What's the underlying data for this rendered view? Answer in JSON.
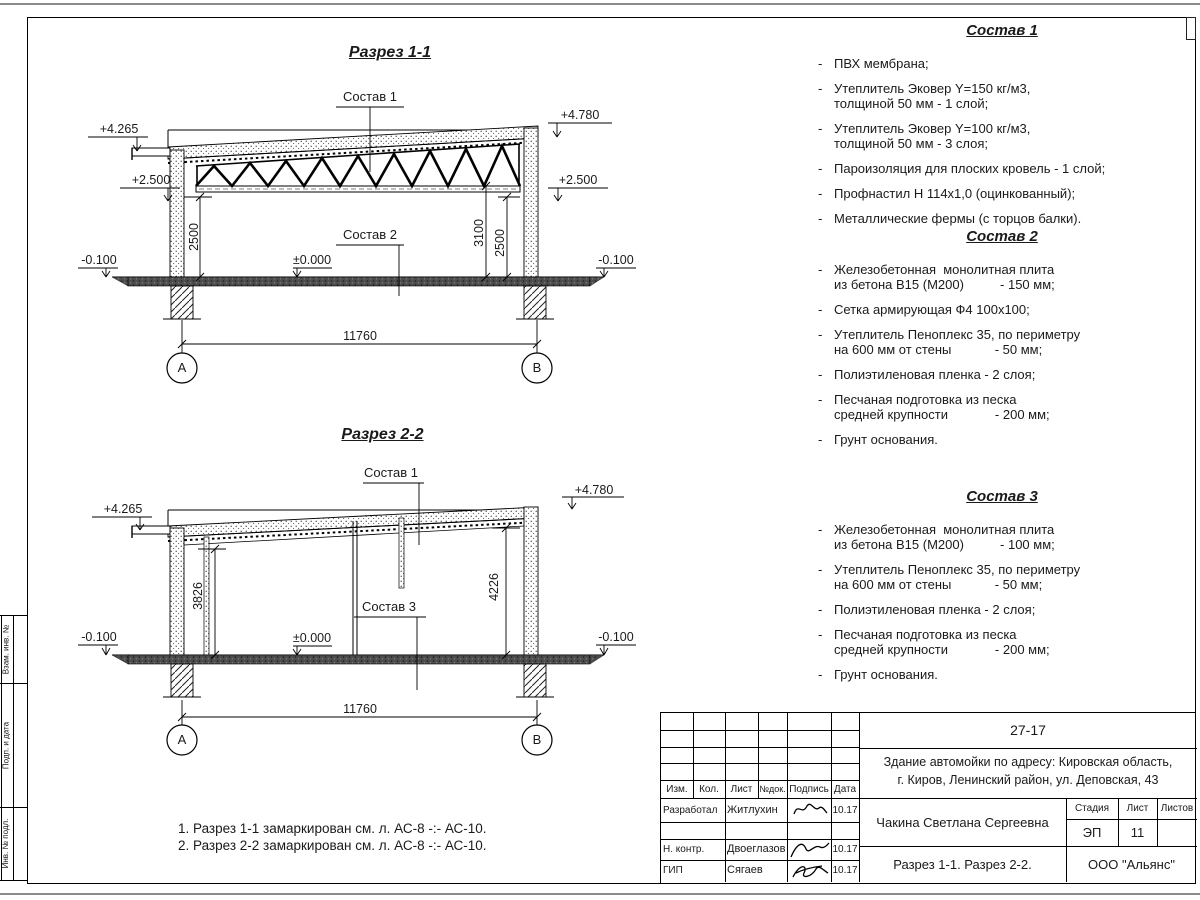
{
  "dash": "-",
  "section1": {
    "title": "Разрез 1-1",
    "callout_top": "Состав 1",
    "callout_mid": "Состав 2",
    "elev_top_left": "+4.265",
    "elev_top_right": "+4.780",
    "elev_mid_left": "+2.500",
    "elev_mid_right": "+2.500",
    "elev_zero": "±0.000",
    "elev_ground_left": "-0.100",
    "elev_ground_right": "-0.100",
    "dim_left": "2500",
    "dim_right_inner": "3100",
    "dim_right_outer": "2500",
    "dim_span": "11760",
    "axis_left": "А",
    "axis_right": "В"
  },
  "section2": {
    "title": "Разрез 2-2",
    "callout_top": "Состав 1",
    "callout_mid": "Состав 3",
    "elev_top_left": "+4.265",
    "elev_top_right": "+4.780",
    "elev_zero": "±0.000",
    "elev_ground_left": "-0.100",
    "elev_ground_right": "-0.100",
    "dim_left": "3826",
    "dim_right": "4226",
    "dim_span": "11760",
    "axis_left": "А",
    "axis_right": "В"
  },
  "compositions": [
    {
      "title": "Состав 1",
      "items": [
        [
          "ПВХ мембрана;"
        ],
        [
          "Утеплитель Эковер Y=150 кг/м3,",
          "толщиной 50 мм - 1 слой;"
        ],
        [
          "Утеплитель Эковер Y=100 кг/м3,",
          "толщиной 50 мм - 3 слоя;"
        ],
        [
          "Пароизоляция для плоских кровель - 1 слой;"
        ],
        [
          "Профнастил Н 114х1,0 (оцинкованный);"
        ],
        [
          "Металлические фермы (с торцов балки)."
        ]
      ]
    },
    {
      "title": "Состав 2",
      "items": [
        [
          "Железобетонная  монолитная плита",
          "из бетона В15 (М200)          - 150 мм;"
        ],
        [
          "Сетка армирующая Ф4 100х100;"
        ],
        [
          "Утеплитель Пеноплекс 35, по периметру",
          "на 600 мм от стены            - 50 мм;"
        ],
        [
          "Полиэтиленовая пленка - 2 слоя;"
        ],
        [
          "Песчаная подготовка из песка",
          "средней крупности             - 200 мм;"
        ],
        [
          "Грунт основания."
        ]
      ]
    },
    {
      "title": "Состав 3",
      "items": [
        [
          "Железобетонная  монолитная плита",
          "из бетона В15 (М200)          - 100 мм;"
        ],
        [
          "Утеплитель Пеноплекс 35, по периметру",
          "на 600 мм от стены            - 50 мм;"
        ],
        [
          "Полиэтиленовая пленка - 2 слоя;"
        ],
        [
          "Песчаная подготовка из песка",
          "средней крупности             - 200 мм;"
        ],
        [
          "Грунт основания."
        ]
      ]
    }
  ],
  "notes": [
    "1. Разрез 1-1 замаркирован см. л. АС-8 -:- АС-10.",
    "2. Разрез 2-2 замаркирован см. л. АС-8 -:- АС-10."
  ],
  "title_block": {
    "doc_code": "27-17",
    "project_line1": "Здание автомойки по адресу: Кировская область,",
    "project_line2": "г. Киров, Ленинский район, ул. Деповская, 43",
    "h_izm": "Изм.",
    "h_kol": "Кол.",
    "h_list": "Лист",
    "h_ndok": "№док.",
    "h_podpis": "Подпись",
    "h_data": "Дата",
    "rows": [
      {
        "role": "Разработал",
        "name": "Житлухин",
        "date": "10.17"
      },
      {
        "role": "Н. контр.",
        "name": "Двоеглазов",
        "date": "10.17"
      },
      {
        "role": "ГИП",
        "name": "Сягаев",
        "date": "10.17"
      }
    ],
    "engineer": "Чакина Светлана Сергеевна",
    "stage_label": "Стадия",
    "sheet_label": "Лист",
    "sheets_label": "Листов",
    "stage": "ЭП",
    "sheet_no": "11",
    "sheets_total": "",
    "sheet_title": "Разрез 1-1. Разрез 2-2.",
    "company": "ООО \"Альянс\""
  },
  "side_stamp": {
    "cells": [
      "Взам. инв. №",
      "Подп. и дата",
      "Инв. № подл."
    ]
  }
}
